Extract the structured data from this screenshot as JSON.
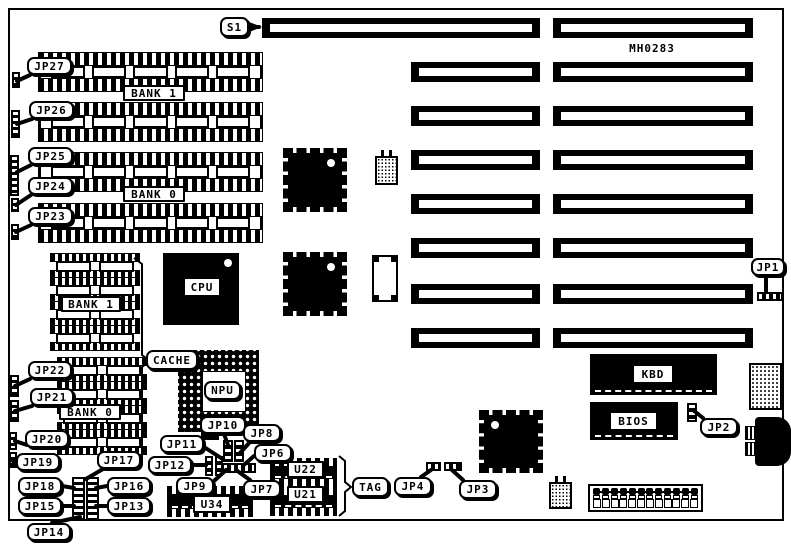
{
  "board": {
    "part_number": "MH0283"
  },
  "labels": [
    {
      "id": "s1",
      "text": "S1",
      "style": "callout",
      "box": [
        220,
        17,
        29,
        20
      ],
      "ptr": [
        249,
        27,
        259,
        27
      ]
    },
    {
      "id": "jp27",
      "text": "JP27",
      "style": "callout",
      "box": [
        27,
        57,
        45,
        18
      ],
      "ptr": [
        30,
        75,
        17,
        81
      ]
    },
    {
      "id": "jp26",
      "text": "JP26",
      "style": "callout",
      "box": [
        29,
        101,
        45,
        18
      ],
      "ptr": [
        32,
        119,
        17,
        124
      ]
    },
    {
      "id": "jp25",
      "text": "JP25",
      "style": "callout",
      "box": [
        28,
        147,
        45,
        18
      ],
      "ptr": [
        31,
        165,
        17,
        172
      ]
    },
    {
      "id": "jp24",
      "text": "JP24",
      "style": "callout",
      "box": [
        28,
        177,
        45,
        18
      ],
      "ptr": [
        31,
        195,
        16,
        205
      ]
    },
    {
      "id": "jp23",
      "text": "JP23",
      "style": "callout",
      "box": [
        28,
        207,
        45,
        18
      ],
      "ptr": [
        31,
        225,
        16,
        232
      ]
    },
    {
      "id": "bank1-simm",
      "text": "BANK 1",
      "style": "box",
      "box": [
        123,
        85,
        62,
        16
      ]
    },
    {
      "id": "bank0-simm",
      "text": "BANK 0",
      "style": "box",
      "box": [
        123,
        186,
        62,
        16
      ]
    },
    {
      "id": "bank1-dip",
      "text": "BANK 1",
      "style": "box",
      "box": [
        61,
        296,
        60,
        16
      ]
    },
    {
      "id": "bank0-dip",
      "text": "BANK 0",
      "style": "box",
      "box": [
        59,
        404,
        62,
        16
      ]
    },
    {
      "id": "jp22",
      "text": "JP22",
      "style": "callout",
      "box": [
        28,
        361,
        44,
        18
      ],
      "ptr": [
        30,
        379,
        15,
        386
      ]
    },
    {
      "id": "jp21",
      "text": "JP21",
      "style": "callout",
      "box": [
        30,
        388,
        44,
        18
      ],
      "ptr": [
        32,
        406,
        15,
        411
      ]
    },
    {
      "id": "jp20",
      "text": "JP20",
      "style": "callout",
      "box": [
        25,
        430,
        44,
        18
      ],
      "ptr": [
        27,
        445,
        15,
        441
      ]
    },
    {
      "id": "jp19",
      "text": "JP19",
      "style": "callout",
      "box": [
        16,
        453,
        44,
        18
      ],
      "ptr": [
        20,
        468,
        13,
        461
      ]
    },
    {
      "id": "jp17",
      "text": "JP17",
      "style": "callout",
      "box": [
        97,
        451,
        44,
        18
      ],
      "ptr": [
        103,
        469,
        86,
        479
      ]
    },
    {
      "id": "jp18",
      "text": "JP18",
      "style": "callout",
      "box": [
        18,
        477,
        44,
        18
      ],
      "ptr": [
        62,
        486,
        74,
        488
      ]
    },
    {
      "id": "jp16",
      "text": "JP16",
      "style": "callout",
      "box": [
        107,
        477,
        44,
        18
      ],
      "ptr": [
        107,
        486,
        96,
        488
      ]
    },
    {
      "id": "jp15",
      "text": "JP15",
      "style": "callout",
      "box": [
        18,
        497,
        44,
        18
      ],
      "ptr": [
        62,
        506,
        74,
        506
      ]
    },
    {
      "id": "jp13",
      "text": "JP13",
      "style": "callout",
      "box": [
        107,
        497,
        44,
        18
      ],
      "ptr": [
        107,
        506,
        96,
        506
      ]
    },
    {
      "id": "jp14",
      "text": "JP14",
      "style": "callout",
      "box": [
        27,
        523,
        44,
        18
      ],
      "ptr": [
        52,
        523,
        80,
        517
      ]
    },
    {
      "id": "jp12",
      "text": "JP12",
      "style": "callout",
      "box": [
        148,
        456,
        44,
        18
      ],
      "ptr": [
        192,
        465,
        206,
        465
      ]
    },
    {
      "id": "jp11",
      "text": "JP11",
      "style": "callout",
      "box": [
        160,
        435,
        44,
        18
      ],
      "ptr": [
        204,
        447,
        221,
        458
      ]
    },
    {
      "id": "jp10",
      "text": "JP10",
      "style": "callout",
      "box": [
        200,
        416,
        46,
        18
      ],
      "ptr": [
        224,
        434,
        228,
        445
      ]
    },
    {
      "id": "jp9",
      "text": "JP9",
      "style": "callout",
      "box": [
        176,
        477,
        38,
        18
      ],
      "ptr": [
        214,
        481,
        226,
        470
      ]
    },
    {
      "id": "jp8",
      "text": "JP8",
      "style": "callout",
      "box": [
        243,
        424,
        38,
        18
      ],
      "ptr": [
        250,
        442,
        240,
        453
      ]
    },
    {
      "id": "jp6",
      "text": "JP6",
      "style": "callout",
      "box": [
        254,
        444,
        38,
        18
      ],
      "ptr": [
        254,
        456,
        245,
        464
      ]
    },
    {
      "id": "jp7",
      "text": "JP7",
      "style": "callout",
      "box": [
        243,
        480,
        38,
        18
      ],
      "ptr": [
        250,
        480,
        236,
        470
      ]
    },
    {
      "id": "cpu",
      "text": "CPU",
      "style": "box",
      "box": [
        183,
        277,
        38,
        20
      ]
    },
    {
      "id": "cache",
      "text": "CACHE",
      "style": "callout",
      "box": [
        146,
        350,
        52,
        20
      ]
    },
    {
      "id": "npu",
      "text": "NPU",
      "style": "callout",
      "box": [
        204,
        381,
        37,
        19
      ]
    },
    {
      "id": "tag",
      "text": "TAG",
      "style": "callout",
      "box": [
        352,
        477,
        37,
        20
      ]
    },
    {
      "id": "u34",
      "text": "U34",
      "style": "box",
      "box": [
        193,
        495,
        38,
        18
      ]
    },
    {
      "id": "u22",
      "text": "U22",
      "style": "box",
      "box": [
        287,
        461,
        37,
        17
      ]
    },
    {
      "id": "u21",
      "text": "U21",
      "style": "box",
      "box": [
        287,
        486,
        37,
        17
      ]
    },
    {
      "id": "jp4",
      "text": "JP4",
      "style": "callout",
      "box": [
        394,
        477,
        38,
        19
      ],
      "ptr": [
        421,
        477,
        431,
        470
      ]
    },
    {
      "id": "jp3",
      "text": "JP3",
      "style": "callout",
      "box": [
        459,
        480,
        38,
        19
      ],
      "ptr": [
        463,
        480,
        452,
        470
      ]
    },
    {
      "id": "jp2",
      "text": "JP2",
      "style": "callout",
      "box": [
        700,
        418,
        38,
        18
      ],
      "ptr": [
        703,
        418,
        693,
        410
      ]
    },
    {
      "id": "jp1",
      "text": "JP1",
      "style": "callout",
      "box": [
        751,
        258,
        34,
        18
      ],
      "ptr": [
        766,
        276,
        766,
        291
      ]
    },
    {
      "id": "kbd",
      "text": "KBD",
      "style": "box",
      "box": [
        632,
        364,
        42,
        20
      ]
    },
    {
      "id": "bios",
      "text": "BIOS",
      "style": "box",
      "box": [
        609,
        411,
        49,
        20
      ]
    },
    {
      "id": "part-number",
      "text": "MH0283",
      "style": "bare",
      "box": [
        624,
        41,
        56,
        15
      ]
    }
  ],
  "components": [
    {
      "id": "slot-s1",
      "type": "slot",
      "box": [
        262,
        18,
        278,
        20
      ]
    },
    {
      "id": "slot-r1",
      "type": "slot",
      "box": [
        553,
        18,
        200,
        20
      ]
    },
    {
      "id": "slot-l2",
      "type": "slot",
      "box": [
        411,
        62,
        129,
        20
      ]
    },
    {
      "id": "slot-r2",
      "type": "slot",
      "box": [
        553,
        62,
        200,
        20
      ]
    },
    {
      "id": "slot-l3",
      "type": "slot",
      "box": [
        411,
        106,
        129,
        20
      ]
    },
    {
      "id": "slot-r3",
      "type": "slot",
      "box": [
        553,
        106,
        200,
        20
      ]
    },
    {
      "id": "slot-l4",
      "type": "slot",
      "box": [
        411,
        150,
        129,
        20
      ]
    },
    {
      "id": "slot-r4",
      "type": "slot",
      "box": [
        553,
        150,
        200,
        20
      ]
    },
    {
      "id": "slot-l5",
      "type": "slot",
      "box": [
        411,
        194,
        129,
        20
      ]
    },
    {
      "id": "slot-r5",
      "type": "slot",
      "box": [
        553,
        194,
        200,
        20
      ]
    },
    {
      "id": "slot-l6",
      "type": "slot",
      "box": [
        411,
        238,
        129,
        20
      ]
    },
    {
      "id": "slot-r6",
      "type": "slot",
      "box": [
        553,
        238,
        200,
        20
      ]
    },
    {
      "id": "slot-l7",
      "type": "slot",
      "box": [
        411,
        284,
        129,
        20
      ]
    },
    {
      "id": "slot-r7",
      "type": "slot",
      "box": [
        553,
        284,
        200,
        20
      ]
    },
    {
      "id": "slot-l8",
      "type": "slot",
      "box": [
        411,
        328,
        129,
        20
      ]
    },
    {
      "id": "slot-r8",
      "type": "slot",
      "box": [
        553,
        328,
        200,
        20
      ]
    },
    {
      "id": "simm-1",
      "type": "simm",
      "box": [
        38,
        52,
        225,
        38
      ]
    },
    {
      "id": "simm-2",
      "type": "simm",
      "box": [
        38,
        102,
        225,
        38
      ]
    },
    {
      "id": "simm-3",
      "type": "simm",
      "box": [
        38,
        152,
        225,
        38
      ]
    },
    {
      "id": "simm-4",
      "type": "simm",
      "box": [
        38,
        203,
        225,
        38
      ]
    },
    {
      "id": "dip-b1-1",
      "type": "dip",
      "box": [
        50,
        253,
        90,
        24
      ]
    },
    {
      "id": "dip-b1-2",
      "type": "dip",
      "box": [
        50,
        277,
        90,
        24
      ]
    },
    {
      "id": "dip-b1-3",
      "type": "dip",
      "box": [
        50,
        301,
        90,
        24
      ]
    },
    {
      "id": "dip-b1-4",
      "type": "dip",
      "box": [
        50,
        325,
        90,
        24
      ]
    },
    {
      "id": "dip-b0-1",
      "type": "dip",
      "box": [
        57,
        357,
        90,
        24
      ]
    },
    {
      "id": "dip-b0-2",
      "type": "dip",
      "box": [
        57,
        381,
        90,
        24
      ]
    },
    {
      "id": "dip-b0-3",
      "type": "dip",
      "box": [
        57,
        405,
        90,
        24
      ]
    },
    {
      "id": "dip-b0-4",
      "type": "dip",
      "box": [
        57,
        429,
        90,
        24
      ]
    },
    {
      "id": "cpu-chip",
      "type": "blackchip",
      "box": [
        163,
        253,
        76,
        72
      ],
      "dot": "tr"
    },
    {
      "id": "qfp-1",
      "type": "qfp",
      "box": [
        283,
        148,
        64,
        64
      ],
      "dot": "tr"
    },
    {
      "id": "qfp-2",
      "type": "qfp",
      "box": [
        283,
        252,
        64,
        64
      ],
      "dot": "tr"
    },
    {
      "id": "qfp-3",
      "type": "qfp",
      "box": [
        479,
        410,
        64,
        63
      ],
      "dot": "tl"
    },
    {
      "id": "npu-socket",
      "type": "pga",
      "box": [
        178,
        350,
        81,
        82
      ],
      "inner": [
        24,
        21,
        42,
        39
      ]
    },
    {
      "id": "crystal-1",
      "type": "xtal",
      "box": [
        375,
        156,
        23,
        29
      ]
    },
    {
      "id": "crystal-2",
      "type": "xtal",
      "box": [
        549,
        482,
        23,
        27
      ]
    },
    {
      "id": "empty-socket",
      "type": "esock",
      "box": [
        372,
        255,
        26,
        47
      ]
    },
    {
      "id": "kbd-chip",
      "type": "chip",
      "box": [
        590,
        354,
        127,
        41
      ]
    },
    {
      "id": "bios-chip",
      "type": "chip",
      "box": [
        590,
        402,
        88,
        38
      ]
    },
    {
      "id": "dotted-chip",
      "type": "dotchip",
      "box": [
        749,
        363,
        33,
        47
      ]
    },
    {
      "id": "din-connector",
      "type": "din",
      "box": [
        755,
        417,
        36,
        49
      ]
    },
    {
      "id": "din-plug-1",
      "type": "dinplug",
      "box": [
        745,
        426,
        12,
        14
      ]
    },
    {
      "id": "din-plug-2",
      "type": "dinplug",
      "box": [
        745,
        442,
        12,
        14
      ]
    },
    {
      "id": "power-connector",
      "type": "power",
      "box": [
        588,
        484,
        115,
        28
      ]
    },
    {
      "id": "u34-socket",
      "type": "usock",
      "box": [
        167,
        486,
        86,
        31
      ]
    },
    {
      "id": "u22-socket",
      "type": "usock",
      "box": [
        270,
        458,
        67,
        29
      ]
    },
    {
      "id": "u21-socket",
      "type": "usock",
      "box": [
        270,
        487,
        67,
        29
      ]
    },
    {
      "id": "pinblock-a",
      "type": "pinblock",
      "box": [
        72,
        477,
        13,
        44
      ]
    },
    {
      "id": "pinblock-b",
      "type": "pinblock",
      "box": [
        86,
        477,
        13,
        44
      ]
    },
    {
      "id": "jumper-jp27",
      "type": "pinblock",
      "box": [
        12,
        72,
        8,
        16
      ]
    },
    {
      "id": "jumper-jp26",
      "type": "pinblock",
      "box": [
        11,
        110,
        9,
        28
      ]
    },
    {
      "id": "jumper-jp25",
      "type": "pinblock",
      "box": [
        10,
        155,
        9,
        41
      ]
    },
    {
      "id": "jumper-jp24",
      "type": "pinblock",
      "box": [
        11,
        198,
        8,
        14
      ]
    },
    {
      "id": "jumper-jp23",
      "type": "pinblock",
      "box": [
        11,
        224,
        8,
        16
      ]
    },
    {
      "id": "jumper-jp22",
      "type": "pinblock",
      "box": [
        10,
        375,
        9,
        22
      ]
    },
    {
      "id": "jumper-jp21",
      "type": "pinblock",
      "box": [
        10,
        400,
        9,
        22
      ]
    },
    {
      "id": "jumper-jp20",
      "type": "pinblock",
      "box": [
        9,
        432,
        8,
        18
      ]
    },
    {
      "id": "jumper-jp19",
      "type": "pinblock",
      "box": [
        9,
        452,
        8,
        16
      ]
    },
    {
      "id": "npu-stub",
      "type": "blackrect",
      "box": [
        201,
        432,
        18,
        8
      ]
    },
    {
      "id": "jumper-c1",
      "type": "jv",
      "box": [
        223,
        440,
        10,
        22
      ]
    },
    {
      "id": "jumper-c2",
      "type": "jv",
      "box": [
        234,
        440,
        10,
        22
      ]
    },
    {
      "id": "jumper-c3",
      "type": "jv",
      "box": [
        205,
        456,
        8,
        20
      ]
    },
    {
      "id": "jumper-c4",
      "type": "jv",
      "box": [
        215,
        456,
        8,
        20
      ]
    },
    {
      "id": "jumper-c5",
      "type": "jh",
      "box": [
        222,
        463,
        34,
        10
      ]
    },
    {
      "id": "jumper-jp1",
      "type": "jh",
      "box": [
        757,
        292,
        26,
        9
      ]
    },
    {
      "id": "jumper-jp2",
      "type": "jv",
      "box": [
        687,
        403,
        10,
        19
      ]
    },
    {
      "id": "jumper-jp4",
      "type": "jh",
      "box": [
        426,
        462,
        15,
        9
      ]
    },
    {
      "id": "jumper-jp3",
      "type": "jh",
      "box": [
        444,
        462,
        18,
        9
      ]
    }
  ],
  "braces": [
    {
      "id": "cache-brace",
      "points": "134,258 142,264 142,355 150,361 142,367 142,464 134,470"
    },
    {
      "id": "tag-brace",
      "points": "339,456 345,461 345,482 351,487 345,492 345,511 339,516"
    }
  ],
  "arrows": [
    {
      "id": "s1-arrow",
      "points": "249,22 262,27 249,32"
    }
  ]
}
